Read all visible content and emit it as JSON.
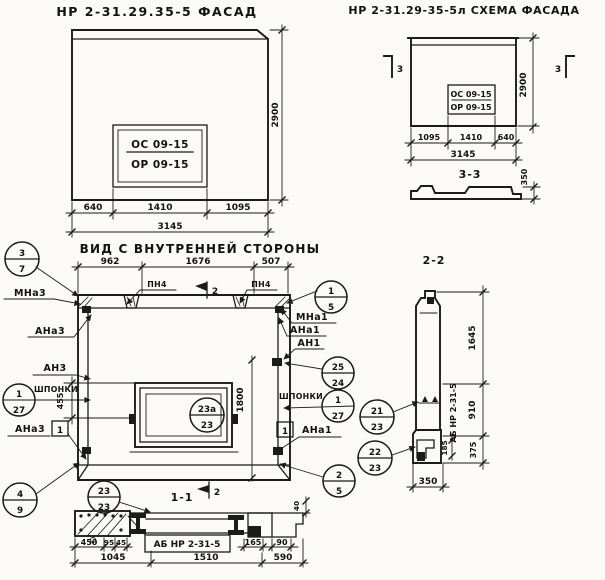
{
  "sheet": {
    "facade": {
      "title": "НР 2-31.29.35-5  ФАСАД",
      "window": {
        "top": "ОС 09-15",
        "bottom": "ОР 09-15"
      },
      "dim_left": "640",
      "dim_mid": "1410",
      "dim_right": "1095",
      "dim_total": "3145",
      "dim_height": "2900"
    },
    "scheme": {
      "title": "НР 2-31.29-35-5л  СХЕМА ФАСАДА",
      "window": {
        "top": "ОС 09-15",
        "bottom": "ОР 09-15"
      },
      "marker": "3",
      "dim_left": "1095",
      "dim_mid": "1410",
      "dim_right": "640",
      "dim_total": "3145",
      "dim_height": "2900",
      "profile": {
        "title": "3-3",
        "dim_height": "350"
      }
    },
    "inner": {
      "title": "ВИД С ВНУТРЕННЕЙ СТОРОНЫ",
      "dim_top_left": "962",
      "dim_top_mid": "1676",
      "dim_top_right": "507",
      "pn_left": "ПН4",
      "pn_right": "ПН4",
      "marker": "2",
      "dim_window": "455",
      "dim_height": "1800",
      "left": {
        "balloon_top": {
          "num": "3",
          "sheet": "7"
        },
        "labels": {
          "mna": "МНа3",
          "ana": "АНа3",
          "an": "АН3",
          "keys": "ШПОНКИ",
          "ana2": "АНа3"
        },
        "balloon_keys": {
          "num": "1",
          "sheet": "27"
        },
        "weld_mark": "1",
        "balloon_bottom": {
          "num": "4",
          "sheet": "9"
        }
      },
      "right": {
        "balloon_top": {
          "num": "1",
          "sheet": "5"
        },
        "labels": {
          "mna": "МНа1",
          "ana": "АНа1",
          "an": "АН1",
          "keys": "ШПОНКИ",
          "ana2": "АНа1"
        },
        "balloon_mid": {
          "num": "25",
          "sheet": "24"
        },
        "balloon_keys": {
          "num": "1",
          "sheet": "27"
        },
        "weld_mark": "1",
        "balloon_bottom": {
          "num": "2",
          "sheet": "5"
        }
      },
      "balloon_window": {
        "num": "23а",
        "sheet": "23"
      }
    },
    "section22": {
      "title": "2-2",
      "balloon_1": {
        "num": "21",
        "sheet": "23"
      },
      "balloon_2": {
        "num": "22",
        "sheet": "23"
      },
      "label_vertical": "АБ НР 2-31-5",
      "dim_h1": "1645",
      "dim_h2": "910",
      "dim_h3": "375",
      "dim_small": "185",
      "dim_width": "350"
    },
    "section11": {
      "title": "1-1",
      "marker": "2",
      "balloon": {
        "num": "23",
        "sheet": "23"
      },
      "label": "АБ НР 2-31-5",
      "dim_450": "450",
      "dim_95": "95",
      "dim_45": "45",
      "dim_1045": "1045",
      "dim_1510": "1510",
      "dim_590": "590",
      "dim_165": "165",
      "dim_90": "90",
      "dim_40": "40"
    }
  }
}
